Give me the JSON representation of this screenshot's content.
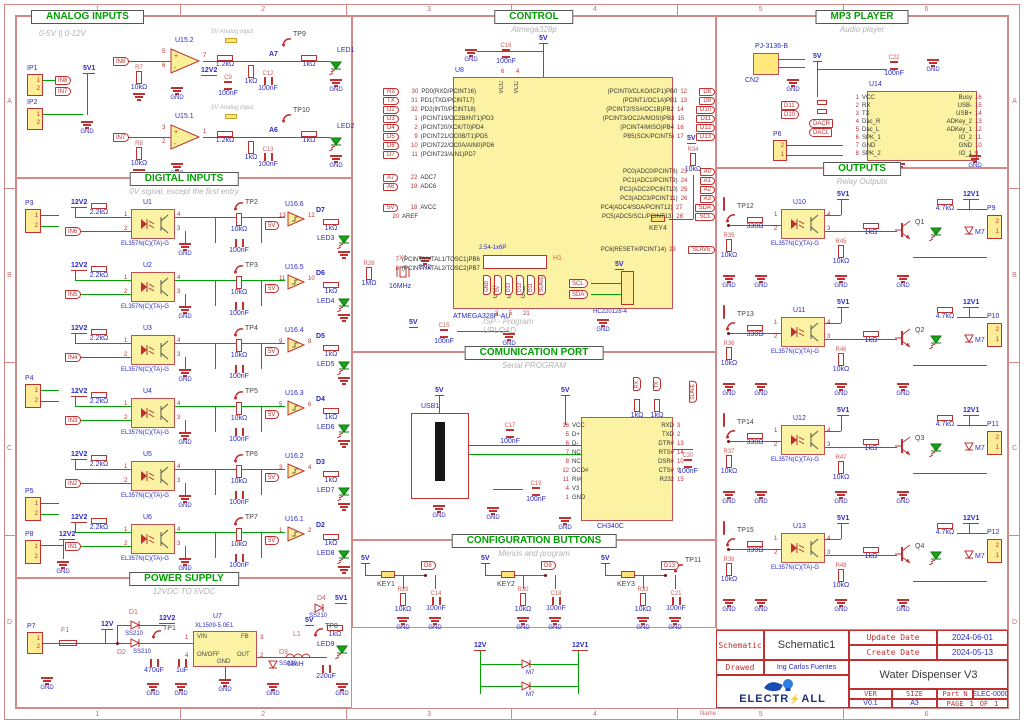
{
  "common": {
    "gnd": "GND",
    "v5": "5V",
    "v5_1": "5V1",
    "v12": "12V",
    "v12_1": "12V1",
    "v12_2": "12V2",
    "vcc": "VCC",
    "pin12": [
      "1",
      "2"
    ],
    "pin21": [
      "2",
      "1"
    ],
    "opto_pins": [
      "1",
      "2",
      "4",
      "3"
    ]
  },
  "frame": {
    "cols": [
      "1",
      "2",
      "3",
      "4",
      "5",
      "6"
    ],
    "rows": [
      "A",
      "B",
      "C",
      "D"
    ],
    "name_label": "Name :"
  },
  "analog": {
    "title": "ANALOG INPUTS",
    "subtitle": "0-5V || 0-12V",
    "ip1": "IP1",
    "ip2": "IP2",
    "cmid_ref": "C9",
    "cmid_val": "100nF",
    "note": "5V Analog input",
    "ch": [
      {
        "in": "IN8",
        "r_ref": "R7",
        "r_val": "10kΩ",
        "u": "U15.2",
        "pin_p": "5",
        "pin_m": "6",
        "pin_o": "7",
        "r_fb": "1.2kΩ",
        "r_div": "1kΩ",
        "net": "A7",
        "tp": "TP9",
        "r_out": "1kΩ",
        "c_ref": "C12",
        "c_val": "100nF",
        "led": "LED1"
      },
      {
        "in": "IN7",
        "r_ref": "R8",
        "r_val": "10kΩ",
        "u": "U15.1",
        "pin_p": "3",
        "pin_m": "2",
        "pin_o": "1",
        "r_fb": "1.2kΩ",
        "r_div": "1kΩ",
        "net": "A6",
        "tp": "TP10",
        "r_out": "1kΩ",
        "c_ref": "C13",
        "c_val": "100nF",
        "led": "LED2"
      }
    ]
  },
  "digital": {
    "title": "DIGITAL INPUTS",
    "subtitle": "0V signal, except the first entry",
    "opto_part": "EL357N(C)(TA)-G",
    "buffer_part": "74HC14D,653",
    "pwr_conn": "P8",
    "r_in": "2.2kΩ",
    "r_pull": "10kΩ",
    "cap": "100nF",
    "r_led": "1kΩ",
    "conns": [
      {
        "ref": "P3"
      },
      {
        "ref": "P4"
      },
      {
        "ref": "P5"
      }
    ],
    "ch": [
      {
        "u": "U1",
        "in": "IN6",
        "tp": "TP2",
        "buf": "U16.6",
        "pi": "13",
        "po": "12",
        "sig": "D7",
        "led": "LED3"
      },
      {
        "u": "U2",
        "in": "IN5",
        "tp": "TP3",
        "buf": "U16.5",
        "pi": "11",
        "po": "10",
        "sig": "D6",
        "led": "LED4"
      },
      {
        "u": "U3",
        "in": "IN4",
        "tp": "TP4",
        "buf": "U16.4",
        "pi": "9",
        "po": "8",
        "sig": "D5",
        "led": "LED5"
      },
      {
        "u": "U4",
        "in": "IN3",
        "tp": "TP5",
        "buf": "U16.3",
        "pi": "5",
        "po": "6",
        "sig": "D4",
        "led": "LED6"
      },
      {
        "u": "U5",
        "in": "IN2",
        "tp": "TP6",
        "buf": "U16.2",
        "pi": "3",
        "po": "4",
        "sig": "D3",
        "led": "LED7"
      },
      {
        "u": "U6",
        "in": "IN1",
        "tp": "TP7",
        "buf": "U16.1",
        "pi": "1",
        "po": "2",
        "sig": "D2",
        "led": "LED8"
      }
    ]
  },
  "power": {
    "title": "POWER SUPPLY",
    "subtitle": "12VDC TO 5VDC",
    "p7": "P7",
    "f1": "F1",
    "d1": "D1",
    "d2": "D2",
    "d3": "D3",
    "d4": "D4",
    "d_part": "SS210",
    "c1v": "470uF",
    "c2v": "1uF",
    "c3v": "220uF",
    "u": "U7",
    "u_part": "XL1509-5.0E1",
    "pin_vin": "VIN",
    "pin_onoff": "ON/OFF",
    "pin_fb": "FB",
    "pin_out": "OUT",
    "pin_gnd": "GND",
    "pn_vin": "1",
    "pn_onoff": "4",
    "pn_fb": "3",
    "pn_out": "2",
    "l1": "L1",
    "l1v": "68uH",
    "tp1": "TP1",
    "tp8": "TP8",
    "r_led": "1kΩ",
    "led": "LED9"
  },
  "control": {
    "title": "CONTROL",
    "subtitle": "Atmega328p",
    "u": "U8",
    "part": "ATMEGA328P-AU",
    "c_top_ref": "C16",
    "c_bot_ref": "C15",
    "cap_val": "100nF",
    "vcc_pins": [
      "6",
      "4"
    ],
    "gnd_pins": [
      "3",
      "5",
      "21"
    ],
    "pins_l": [
      {
        "n": "30",
        "name": "PD0(RXD/PCINT16)",
        "net": "RX"
      },
      {
        "n": "31",
        "name": "PD1(TXD/PCINT17)",
        "net": "TX"
      },
      {
        "n": "32",
        "name": "PD2(INT0/PCINT18)",
        "net": "D2"
      },
      {
        "n": "1",
        "name": "(PCINT19/OC2B/INT1)PD3",
        "net": "D3"
      },
      {
        "n": "2",
        "name": "(PCINT20/XCK/T0)PD4",
        "net": "D4"
      },
      {
        "n": "9",
        "name": "(PCINT21/OC0B/T1)PD5",
        "net": "D5"
      },
      {
        "n": "10",
        "name": "(PCINT22/OC0A/AIN0)PD6",
        "net": "D6"
      },
      {
        "n": "11",
        "name": "(PCINT23/AIN1)PD7",
        "net": "D7"
      }
    ],
    "pins_adc": [
      {
        "n": "22",
        "name": "ADC7",
        "net": "A7"
      },
      {
        "n": "19",
        "name": "ADC6",
        "net": "A6"
      }
    ],
    "pins_misc": [
      {
        "n": "18",
        "name": "AVCC",
        "net": "5V"
      },
      {
        "n": "20",
        "name": "AREF"
      }
    ],
    "pins_xtal": [
      {
        "n": "7",
        "name": "(PCINT6/XTAL1/TOSC1)PB6"
      },
      {
        "n": "8",
        "name": "(PCINT7/XTAL2/TOSC2)PB7"
      }
    ],
    "pins_rb": [
      {
        "n": "12",
        "name": "(PCINT0/CLKO/ICP1)PB0",
        "net": "D8"
      },
      {
        "n": "13",
        "name": "(PCINT1/OC1A)PB1",
        "net": "D9"
      },
      {
        "n": "14",
        "name": "(PCINT2/SS#/OC1B)PB2",
        "net": "D10"
      },
      {
        "n": "15",
        "name": "(PCINT3/OC2A/MOSI)PB3",
        "net": "D11"
      },
      {
        "n": "16",
        "name": "(PCINT4/MISO)PB4",
        "net": "D12"
      },
      {
        "n": "17",
        "name": "PB5(SCK/PCINT5)",
        "net": "D13"
      }
    ],
    "pins_rc": [
      {
        "n": "23",
        "name": "PC0(ADC0/PCINT8)",
        "net": "A0"
      },
      {
        "n": "24",
        "name": "PC1(ADC1/PCINT9)",
        "net": "A1"
      },
      {
        "n": "25",
        "name": "PC2(ADC2/PCINT10)",
        "net": "A2"
      },
      {
        "n": "26",
        "name": "PC3(ADC3/PCINT11)",
        "net": "A3"
      },
      {
        "n": "27",
        "name": "PC4(ADC4/SDA/PCINT12)",
        "net": "SDA"
      },
      {
        "n": "28",
        "name": "PC5(ADC5/SCL/PCINT13)",
        "net": "SCL"
      }
    ],
    "pins_rst": [
      {
        "n": "29",
        "name": "PC6(RESET#/PCINT14)",
        "net": "SLAVE"
      }
    ],
    "xtal_ref": "X1",
    "xtal_val": "16MHz",
    "r28": "R28",
    "r28_val": "1MΩ",
    "r34": "R34",
    "r34_val": "10kΩ",
    "key": "KEY4",
    "isp_ref": "H1",
    "isp_part": "2.54-1x6P",
    "isp_cap1": "ISP - Program",
    "isp_cap2": "UPLOAD",
    "isp_nets": [
      "GND",
      "5V",
      "D13",
      "D12",
      "D11",
      "SLAVE"
    ],
    "i2c_part": "HC220128-4",
    "i2c_scl": "SCL",
    "i2c_sda": "SDA"
  },
  "comm": {
    "title": "COMUNICATION PORT",
    "subtitle": "Serial PROGRAM",
    "usb": "USB1",
    "u_part": "CH340C",
    "pins_l": [
      {
        "n": "16",
        "name": "VCC"
      },
      {
        "n": "5",
        "name": "D+"
      },
      {
        "n": "6",
        "name": "D-"
      },
      {
        "n": "7",
        "name": "NC"
      },
      {
        "n": "8",
        "name": "NC"
      },
      {
        "n": "12",
        "name": "DCD#"
      },
      {
        "n": "11",
        "name": "RI#"
      },
      {
        "n": "4",
        "name": "V3"
      },
      {
        "n": "1",
        "name": "GND"
      }
    ],
    "pins_r": [
      {
        "n": "3",
        "name": "RXD"
      },
      {
        "n": "2",
        "name": "TXD"
      },
      {
        "n": "13",
        "name": "DTR#"
      },
      {
        "n": "14",
        "name": "RTS#"
      },
      {
        "n": "10",
        "name": "DSR#"
      },
      {
        "n": "9",
        "name": "CTS#"
      },
      {
        "n": "15",
        "name": "R232"
      }
    ],
    "c17": "C17",
    "c19": "C19",
    "c20": "C20",
    "cap_val": "100nF",
    "r1": "1kΩ",
    "r2": "1kΩ",
    "net_tx": "TX",
    "net_rx": "RX",
    "net_slave": "SLAVE"
  },
  "buttons": {
    "title": "CONFIGURATION BUTTONS",
    "subtitle": "Menús and program",
    "ch": [
      {
        "key": "KEY1",
        "r": "R29",
        "rv": "10kΩ",
        "c": "C14",
        "cv": "100nF",
        "sig": "D8"
      },
      {
        "key": "KEY2",
        "r": "R30",
        "rv": "10kΩ",
        "c": "C18",
        "cv": "100nF",
        "sig": "D9"
      },
      {
        "key": "KEY3",
        "r": "R33",
        "rv": "10kΩ",
        "c": "C21",
        "cv": "100nF",
        "sig": "D13",
        "tp": "TP11"
      }
    ]
  },
  "mp3": {
    "title": "MP3 PLAYER",
    "subtitle": "Audio player",
    "jack_part": "PJ-3136-B",
    "jack_ref": "CN2",
    "cap_ref": "C22",
    "cap_val": "100nF",
    "u": "U14",
    "spk": "P6",
    "net_d11": "D11",
    "net_d10": "D10",
    "net_dacr": "DACR",
    "net_dacl": "DACL",
    "pins_l": [
      {
        "n": "1",
        "name": "VCC"
      },
      {
        "n": "2",
        "name": "RX"
      },
      {
        "n": "3",
        "name": "TX"
      },
      {
        "n": "4",
        "name": "Dac_R"
      },
      {
        "n": "5",
        "name": "Dac_L"
      },
      {
        "n": "6",
        "name": "SPK_1"
      },
      {
        "n": "7",
        "name": "GND"
      },
      {
        "n": "8",
        "name": "SPK_2"
      }
    ],
    "pins_r": [
      {
        "n": "16",
        "name": "Busy"
      },
      {
        "n": "15",
        "name": "USB-"
      },
      {
        "n": "14",
        "name": "USB+"
      },
      {
        "n": "13",
        "name": "ADKey_2"
      },
      {
        "n": "12",
        "name": "ADKey_1"
      },
      {
        "n": "11",
        "name": "IO_2"
      },
      {
        "n": "10",
        "name": "GND"
      },
      {
        "n": "9",
        "name": "IO_1"
      }
    ]
  },
  "outputs": {
    "title": "OUTPUTS",
    "subtitle": "Relay Outputs",
    "opto_part": "EL357N(C)(TA)-G",
    "r_in": "330Ω",
    "r_base": "1kΩ",
    "r_col": "4.7kΩ",
    "ch": [
      {
        "tp": "TP12",
        "rp": "R35",
        "rpv": "10kΩ",
        "u": "U10",
        "re": "R45",
        "rev": "10kΩ",
        "q": "Q1",
        "d": "M7",
        "p": "P9"
      },
      {
        "tp": "TP13",
        "rp": "R36",
        "rpv": "10kΩ",
        "u": "U11",
        "re": "R46",
        "rev": "10kΩ",
        "q": "Q2",
        "d": "M7",
        "p": "P10"
      },
      {
        "tp": "TP14",
        "rp": "R37",
        "rpv": "10kΩ",
        "u": "U12",
        "re": "R47",
        "rev": "10kΩ",
        "q": "Q3",
        "d": "M7",
        "p": "P11"
      },
      {
        "tp": "TP15",
        "rp": "R38",
        "rpv": "10kΩ",
        "u": "U13",
        "re": "R48",
        "rev": "10kΩ",
        "q": "Q4",
        "d": "M7",
        "p": "P12"
      }
    ]
  },
  "aux": {
    "left": "12V",
    "right": "12V1",
    "d": "M7"
  },
  "title_block": {
    "schematic_label": "Schematic",
    "schematic_value": "Schematic1",
    "update_label": "Update Date",
    "update_value": "2024-06-01",
    "create_label": "Create Date",
    "create_value": "2024-05-13",
    "drawed_label": "Drawed",
    "drawed_value": "Ing Carlos Fuentes",
    "product": "Water Dispenser V3",
    "ver_label": "VER",
    "ver_value": "V0.1",
    "size_label": "SIZE",
    "size_value": "A3",
    "part_label": "Part N",
    "part_value": "ELEC-0000",
    "page_label": "PAGE",
    "page_num": "1",
    "of_label": "OF",
    "of_num": "1",
    "brand_a": "ELECTR",
    "brand_b": "ALL"
  }
}
